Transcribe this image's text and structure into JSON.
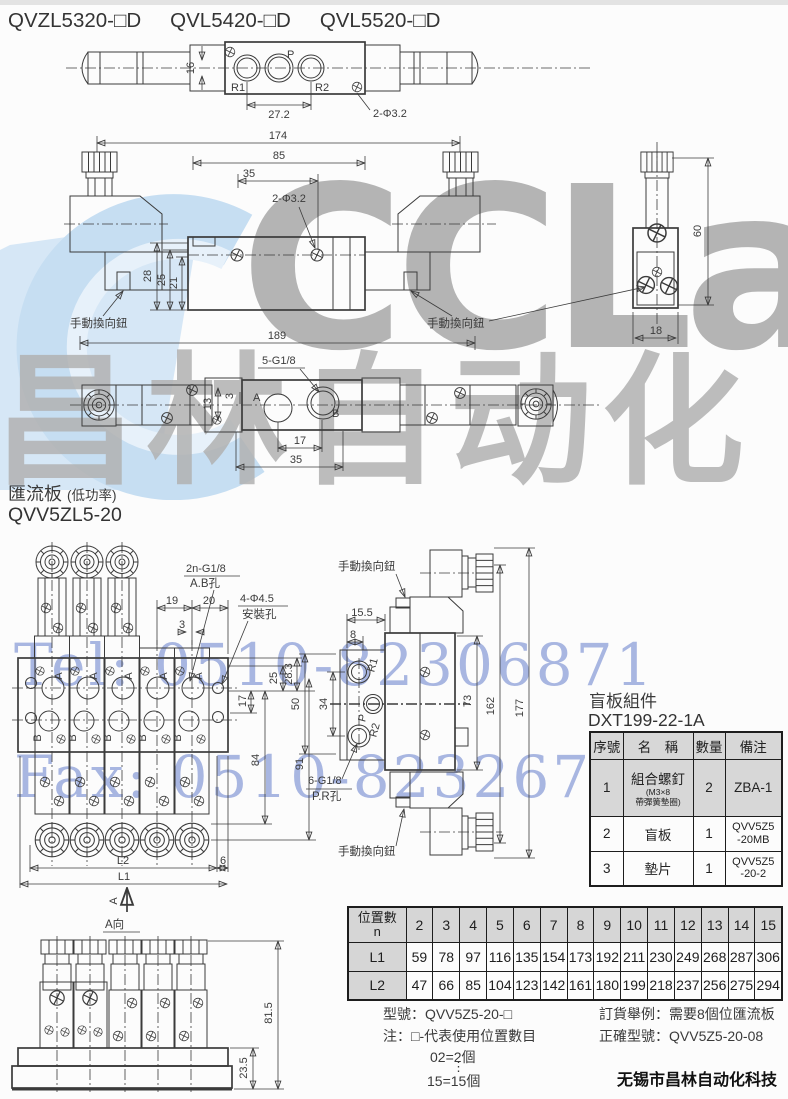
{
  "page": {
    "models": [
      "QVZL5320-□D",
      "QVL5420-□D",
      "QVL5520-□D"
    ],
    "section": {
      "title": "匯流板",
      "subtitle": "(低功率)",
      "model": "QVV5ZL5-20"
    },
    "company": "无锡市昌林自动化科技"
  },
  "watermarks": {
    "logo_latin": "CCLair",
    "logo_cn": "昌林自动化",
    "tel": "Tel: 0510-82306871",
    "fax": "Fax: 0510-82326771",
    "colors": {
      "blue_text": "#748ad0",
      "gray_text": "#b4b4b4",
      "swoosh": "#c6def2"
    }
  },
  "top_view": {
    "ports": {
      "r1": "R1",
      "p": "P",
      "r2": "R2"
    },
    "dims": {
      "height": "16",
      "port_span": "27.2",
      "holes": "2-Φ3.2"
    }
  },
  "front_view": {
    "dims": {
      "overall_top": "174",
      "body": "85",
      "half": "35",
      "holes": "2-Φ3.2",
      "h28": "28",
      "h25": "25",
      "h21": "21",
      "overall_bottom": "189"
    },
    "manual_knob": "手動換向鈕"
  },
  "side_view": {
    "dims": {
      "height": "60",
      "width": "18"
    }
  },
  "bottom_view": {
    "thread_callout": "5-G1/8",
    "ports": {
      "a": "A",
      "b": "B"
    },
    "dims": {
      "h13": "13",
      "s3": "3",
      "d17": "17",
      "d35": "35"
    }
  },
  "manifold_front": {
    "thread_callout": "2n-G1/8",
    "thread_callout_sub": "A.B孔",
    "mount_callout": "4-Φ4.5",
    "mount_callout_sub": "安裝孔",
    "ports": {
      "a": "A",
      "b": "B"
    },
    "dims": {
      "d19": "19",
      "d20": "20",
      "d3": "3",
      "d25": "25",
      "d283": "28.3",
      "d17": "17",
      "d84": "84",
      "d91": "91",
      "l2": "L2",
      "l1": "L1",
      "d6": "6"
    },
    "view_arrow": "A"
  },
  "manifold_side": {
    "manual_knob": "手動換向鈕",
    "thread_callout": "6-G1/8",
    "thread_callout_sub": "P.R孔",
    "ports": {
      "r1": "R1",
      "p": "P",
      "r2": "R2"
    },
    "dims": {
      "d155": "15.5",
      "d8": "8",
      "d50": "50",
      "d34": "34",
      "d73": "73",
      "d162": "162",
      "d177": "177"
    }
  },
  "a_view": {
    "label": "A向",
    "dims": {
      "d815": "81.5",
      "d235": "23.5"
    }
  },
  "blind_plate": {
    "title": "盲板組件",
    "part_no": "DXT199-22-1A",
    "headers": [
      "序號",
      "名　稱",
      "數量",
      "備注"
    ],
    "rows": [
      {
        "no": "1",
        "name": "組合螺釘",
        "name_sub": "(M3×8\n帶彈簧墊圈)",
        "qty": "2",
        "remark": "ZBA-1"
      },
      {
        "no": "2",
        "name": "盲板",
        "name_sub": "",
        "qty": "1",
        "remark": "QVV5Z5\n-20MB"
      },
      {
        "no": "3",
        "name": "墊片",
        "name_sub": "",
        "qty": "1",
        "remark": "QVV5Z5\n-20-2"
      }
    ]
  },
  "position_table": {
    "header_line1": "位置數",
    "header_line2": "n",
    "l1_label": "L1",
    "l2_label": "L2",
    "positions": [
      "2",
      "3",
      "4",
      "5",
      "6",
      "7",
      "8",
      "9",
      "10",
      "11",
      "12",
      "13",
      "14",
      "15"
    ],
    "l1": [
      "59",
      "78",
      "97",
      "116",
      "135",
      "154",
      "173",
      "192",
      "211",
      "230",
      "249",
      "268",
      "287",
      "306"
    ],
    "l2": [
      "47",
      "66",
      "85",
      "104",
      "123",
      "142",
      "161",
      "180",
      "199",
      "218",
      "237",
      "256",
      "275",
      "294"
    ]
  },
  "ordering": {
    "model_line": "型號：QVV5Z5-20-□",
    "note_line": "注：□-代表使用位置數目",
    "range_start": "02=2個",
    "range_dots": "⋮",
    "range_end": "15=15個",
    "example_line": "訂貨舉例：需要8個位匯流板",
    "correct_line": "正確型號：QVV5Z5-20-08"
  }
}
